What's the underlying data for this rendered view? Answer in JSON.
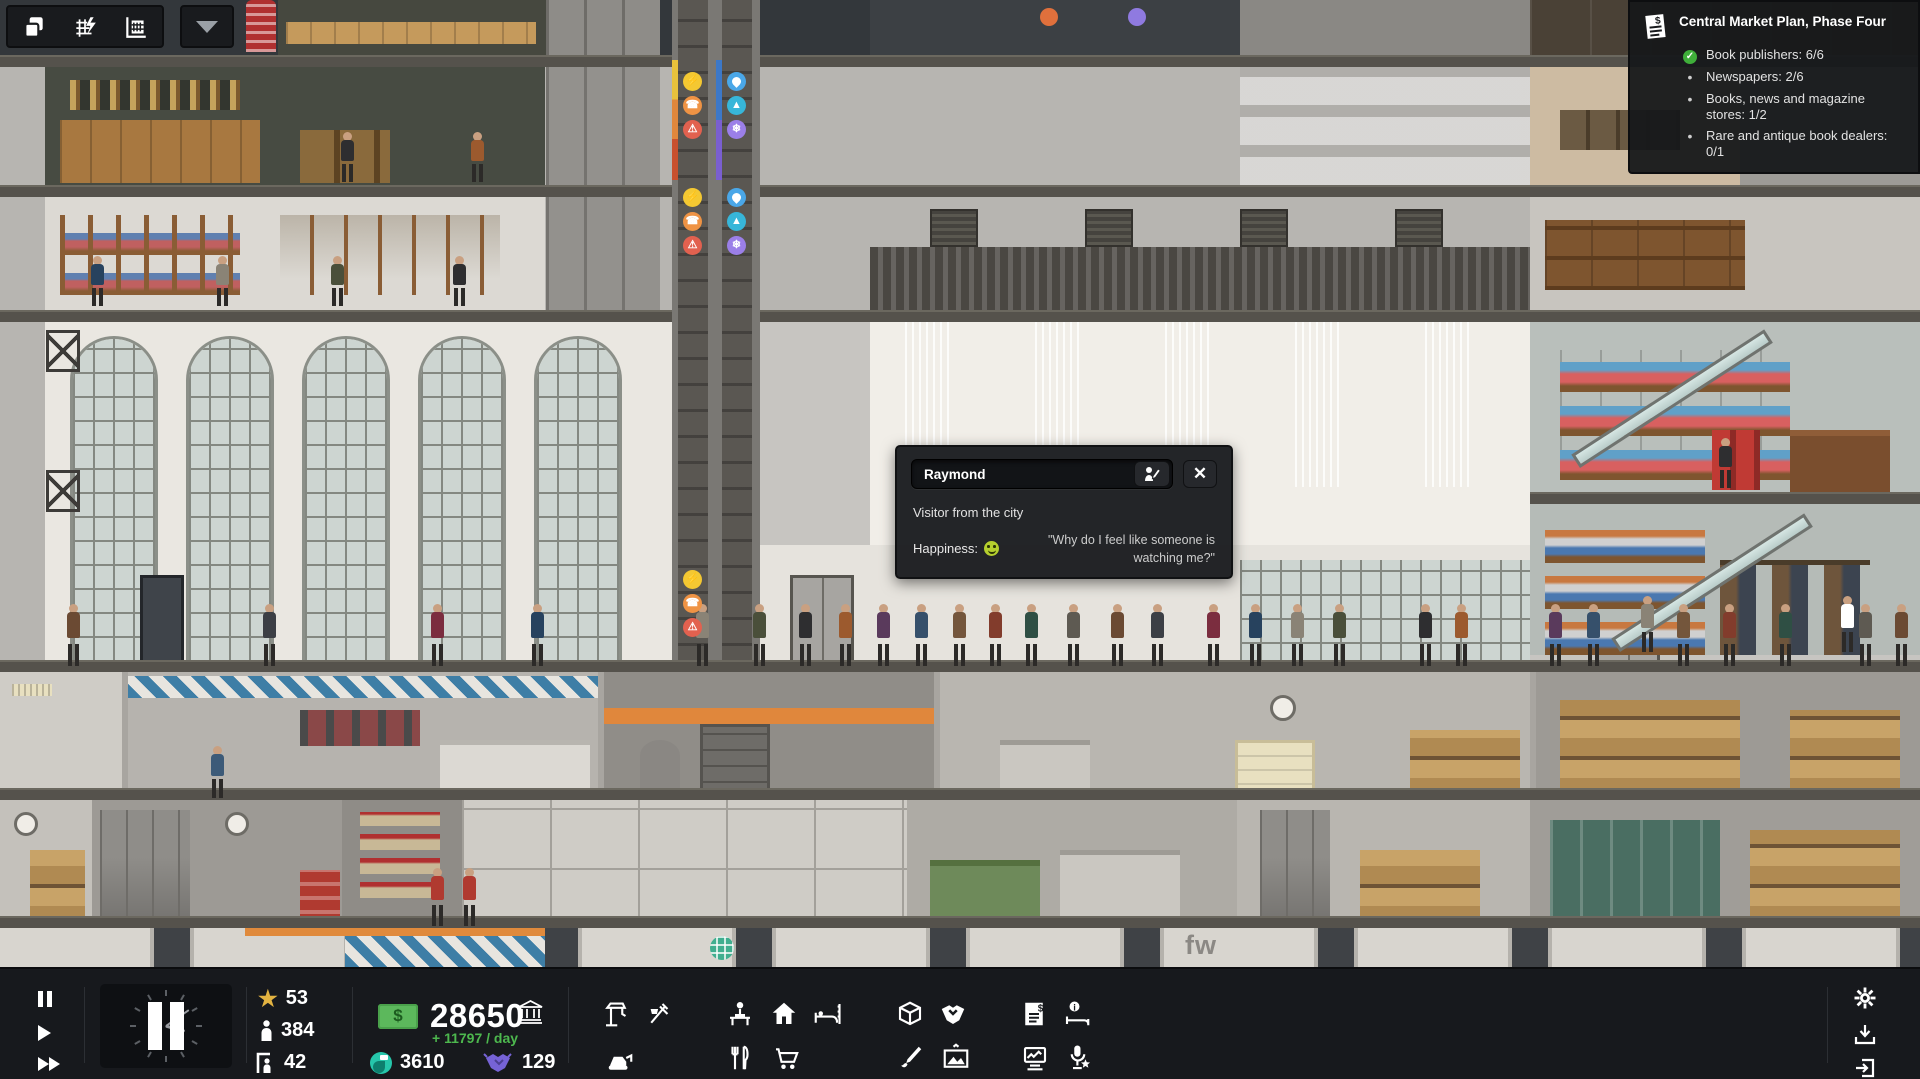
{
  "hud": {
    "view_toolbar": {
      "buttons": [
        {
          "icon": "layers-icon"
        },
        {
          "icon": "zoning-grid-icon"
        },
        {
          "icon": "building-overlay-icon"
        }
      ],
      "collapse_icon": "chevron-down"
    },
    "objectives": {
      "title": "Central Market Plan, Phase Four",
      "items": [
        {
          "text": "Book publishers: 6/6",
          "done": true
        },
        {
          "text": "Newspapers: 2/6",
          "done": false
        },
        {
          "text": "Books, news and magazine stores: 1/2",
          "done": false
        },
        {
          "text": "Rare and antique book dealers: 0/1",
          "done": false
        }
      ]
    },
    "person_popup": {
      "name": "Raymond",
      "description": "Visitor from the city",
      "happiness_label": "Happiness:",
      "happiness_state": "happy",
      "quote": "\"Why do I feel like someone is watching me?\""
    },
    "status": {
      "stars": "53",
      "population": "384",
      "visitors": "42",
      "money": "28650",
      "income_per_day": "+ 11797 / day",
      "influence": "3610",
      "favors": "129"
    },
    "build_menu": {
      "row1": [
        "construction",
        "utilities",
        "offices",
        "apartments",
        "hotels",
        "supplies",
        "services",
        "contracts",
        "room-info"
      ],
      "row2": [
        "demolish",
        "restaurants",
        "retail",
        "decor",
        "art",
        "media",
        "events"
      ]
    },
    "system_menu": [
      "settings",
      "save",
      "exit"
    ]
  },
  "scene": {
    "storefront_sign": "fw"
  },
  "colors": {
    "money_green": "#5cb85c",
    "income_green": "#4db84e",
    "star_gold": "#e3b341",
    "influence_teal": "#26c6ab",
    "favors_purple": "#7663d6",
    "check_green": "#3fae3a",
    "happy_face": "#b5cf2e"
  }
}
